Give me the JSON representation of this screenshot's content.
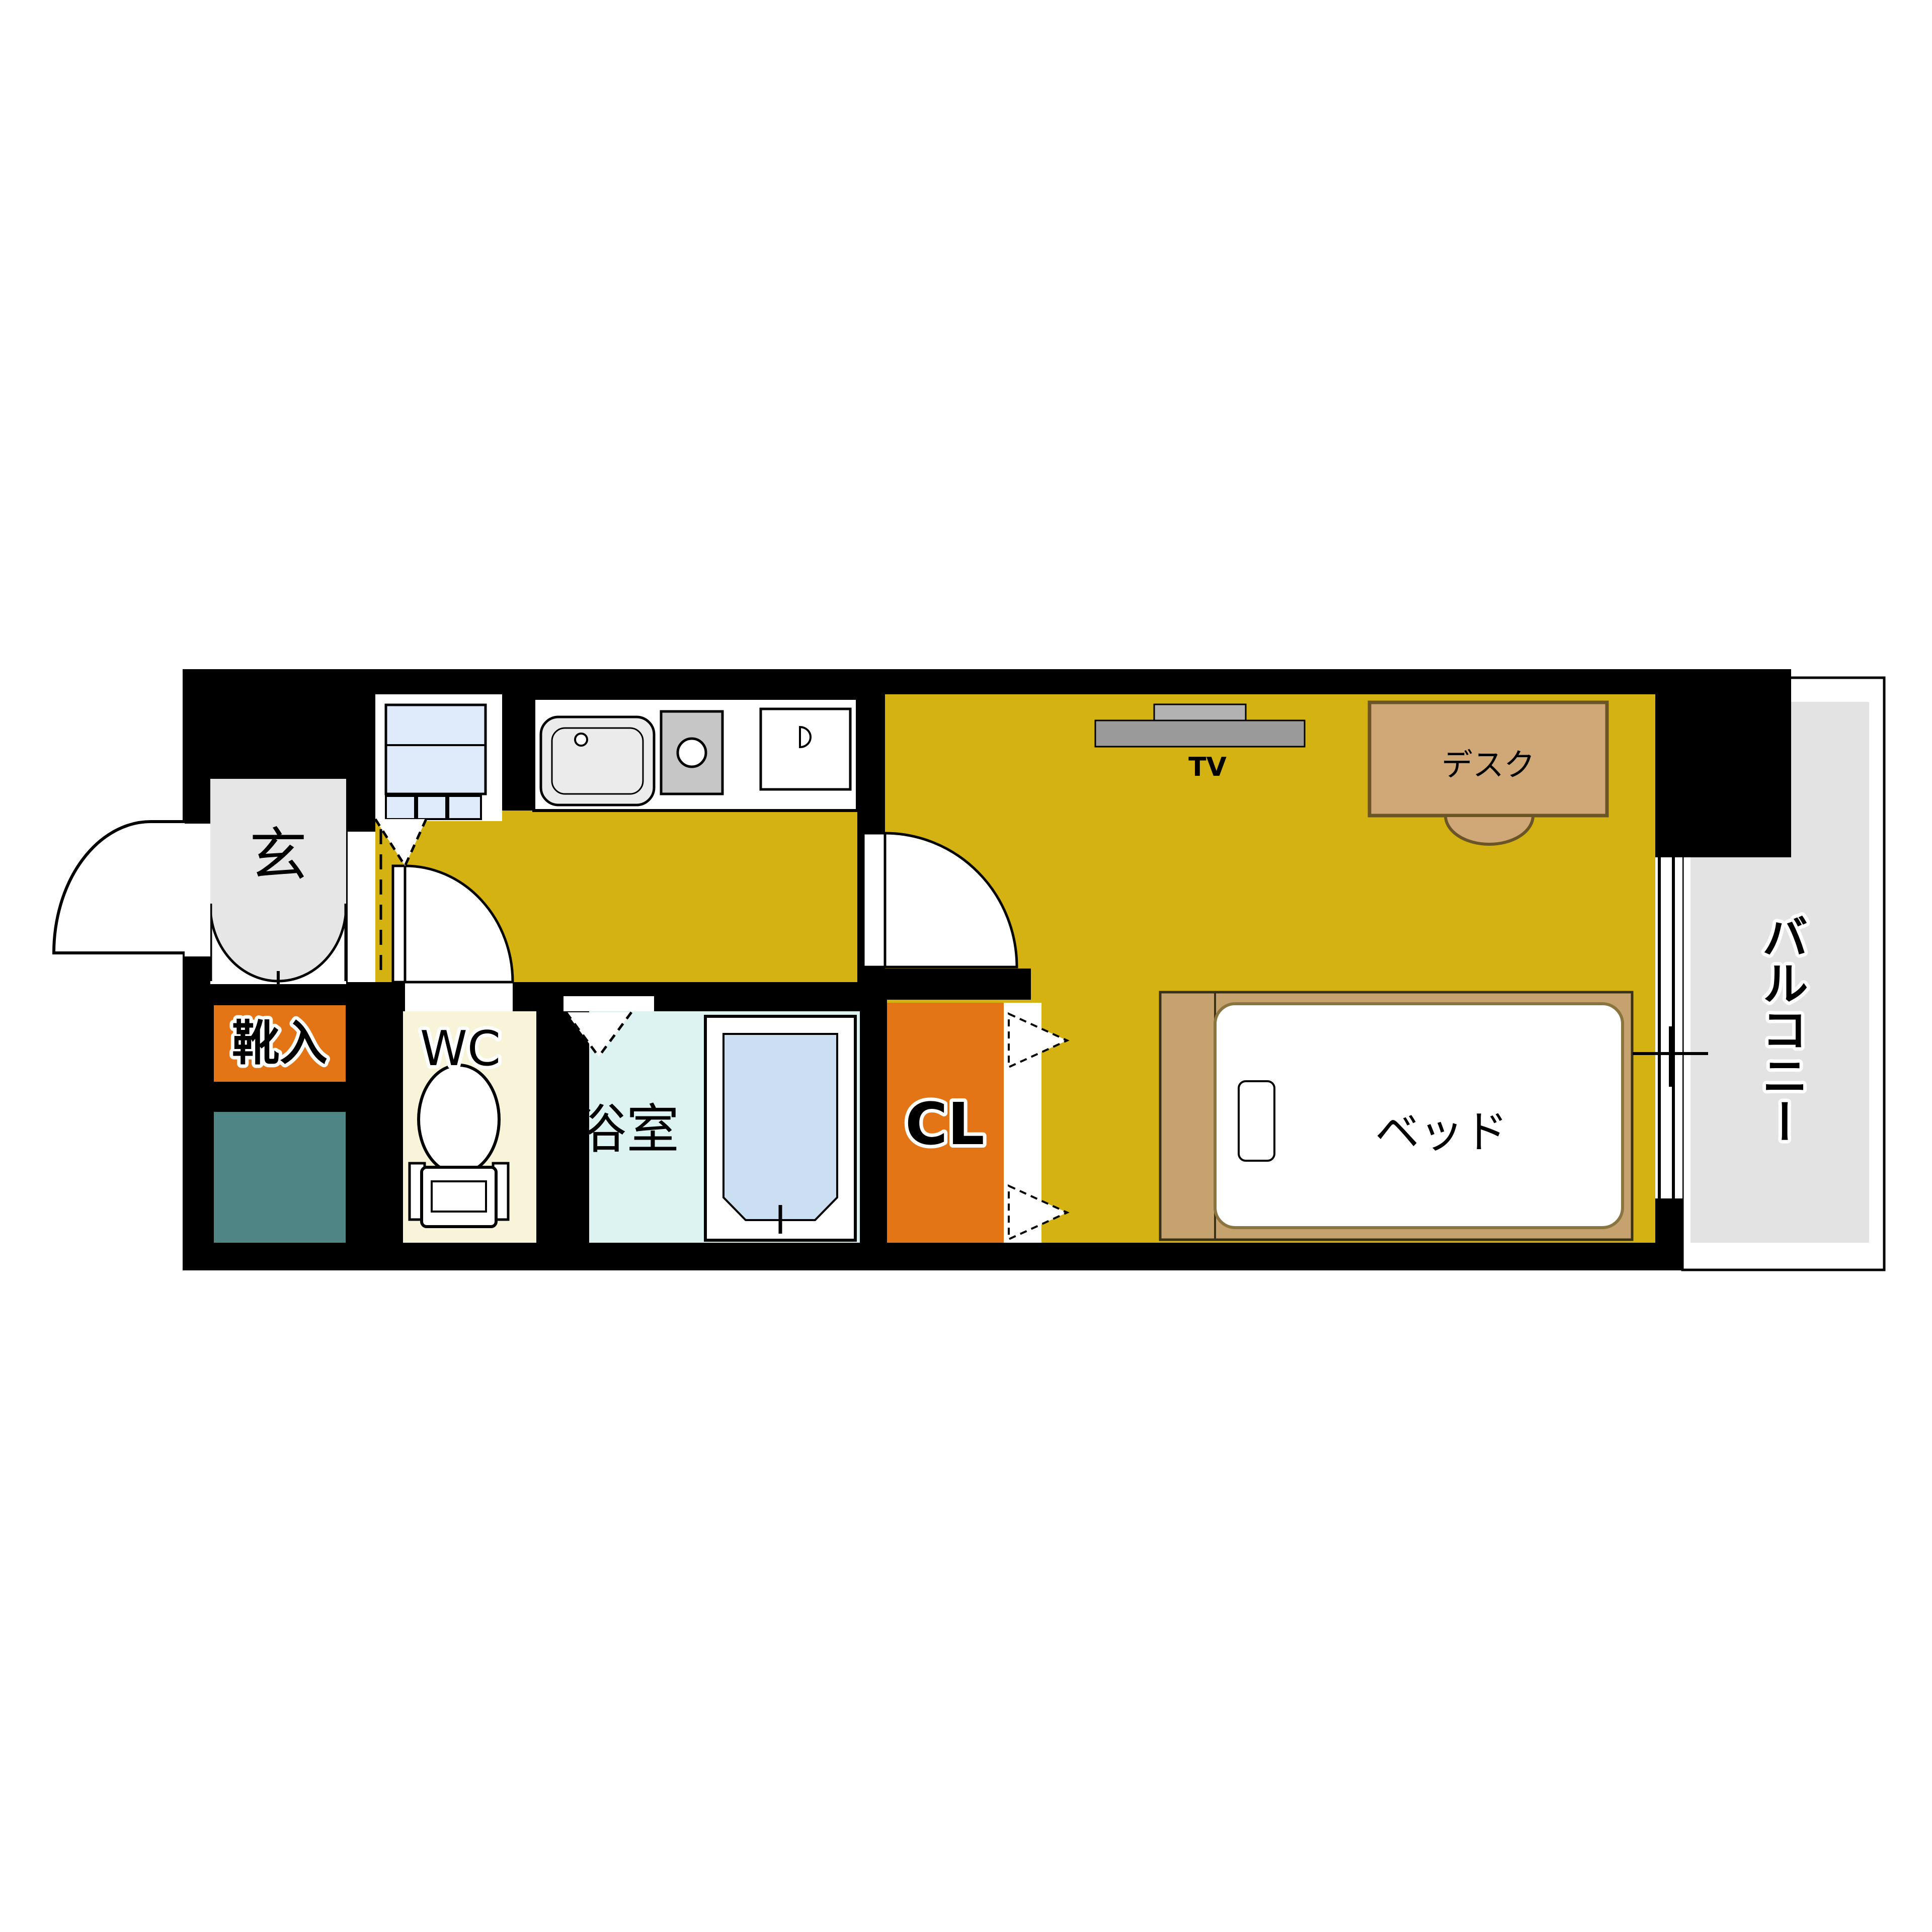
{
  "plan": {
    "type": "apartment-floor-plan-1K",
    "rooms": {
      "entrance_label": "玄",
      "shoe_storage_label": "靴入",
      "wc_label": "WC",
      "bathroom_label": "浴室",
      "closet_label": "CL",
      "balcony_label": "バルコニー"
    },
    "furniture": {
      "tv_label": "TV",
      "desk_label": "デスク",
      "bed_label": "ベッド"
    }
  },
  "colors": {
    "wall": "#000000",
    "floor_yellow": "#d4b211",
    "accent_orange": "#e37516",
    "teal_box": "#4f8585",
    "entrance_gray": "#e6e6e6",
    "wc_cream": "#f8f4d9",
    "bath_cyan": "#dcf3f2",
    "tub_blue": "#cbdef2",
    "appliance_blue": "#dfeafa",
    "balcony_gray": "#e3e3e3",
    "desk_tan": "#d0a877",
    "desk_border": "#6b5526",
    "bed_tan": "#c6a26e",
    "mattress_border": "#8a7440",
    "tv_gray": "#9a9a9a",
    "tv_back_gray": "#b2b2b2",
    "sink_gray": "#ebebeb",
    "stove_gray": "#c6c6c6"
  }
}
